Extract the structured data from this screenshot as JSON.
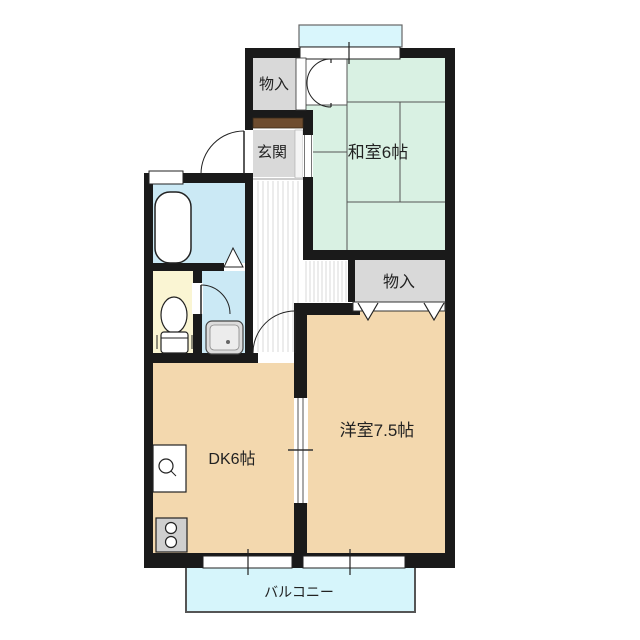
{
  "floorplan": {
    "type": "apartment-floor-plan",
    "labels": {
      "storage_top": "物入",
      "entrance": "玄関",
      "japanese_room": "和室6帖",
      "storage_right": "物入",
      "western_room": "洋室7.5帖",
      "dining_kitchen": "DK6帖",
      "balcony": "バルコニー"
    },
    "colors": {
      "wall": "#1a1a1a",
      "tatami_room": "#d9f1e3",
      "western_room": "#f3d8ae",
      "dining_kitchen": "#f3d8ae",
      "bathroom": "#cbe9f5",
      "washroom": "#cbe9f5",
      "toilet_room": "#faf5d3",
      "storage": "#d9d9d9",
      "entrance_hall": "#d9d9d9",
      "balcony": "#d6f5fb",
      "window": "#d9f6fc",
      "threshold": "#6e4c2e",
      "hall_stripe": "#d9d9d9",
      "label_text": "#222222"
    }
  }
}
